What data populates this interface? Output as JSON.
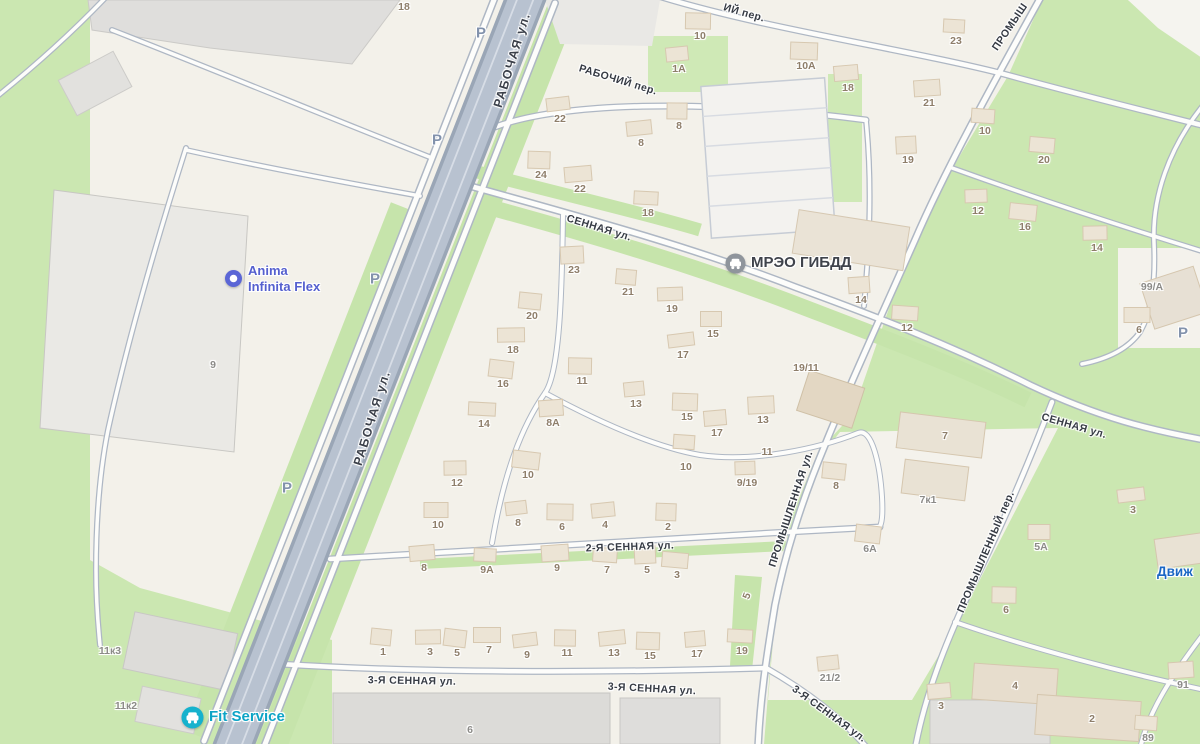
{
  "map": {
    "colors": {
      "green_area": "#cbe7b1",
      "road_major_fill": "#b8c2d0",
      "road_casing": "#aeb7c4",
      "street_text": "#363b44",
      "address_text": "#8e7e6a",
      "poi_anima": "#5560cf",
      "poi_mreo": "#3f434b",
      "poi_fit_service": "#0da4c6",
      "poi_dvizh": "#1a66c4",
      "parking_text": "#8292ac"
    },
    "parking_glyph": "P",
    "street_labels": [
      {
        "t": "РАБОЧАЯ ул.",
        "x": 512,
        "y": 60,
        "rot": -73,
        "major": true
      },
      {
        "t": "РАБОЧАЯ ул.",
        "x": 372,
        "y": 418,
        "rot": -73,
        "major": true
      },
      {
        "t": "РАБОЧИЙ пер.",
        "x": 618,
        "y": 80,
        "rot": 17
      },
      {
        "t": "ИЙ пер.",
        "x": 744,
        "y": 13,
        "rot": 16
      },
      {
        "t": "СЕННАЯ ул.",
        "x": 599,
        "y": 228,
        "rot": 17
      },
      {
        "t": "СЕННАЯ ул.",
        "x": 1074,
        "y": 426,
        "rot": 16
      },
      {
        "t": "2-Я СЕННАЯ ул.",
        "x": 630,
        "y": 547,
        "rot": -2
      },
      {
        "t": "3-Я СЕННАЯ ул.",
        "x": 412,
        "y": 681,
        "rot": 1
      },
      {
        "t": "3-Я СЕННАЯ ул.",
        "x": 652,
        "y": 689,
        "rot": 3
      },
      {
        "t": "3-Я СЕННАЯ ул.",
        "x": 829,
        "y": 714,
        "rot": 36
      },
      {
        "t": "ПРОМЫШЛЕННАЯ ул.",
        "x": 791,
        "y": 509,
        "rot": -72
      },
      {
        "t": "ПРОМЫШЛЕННЫЙ пер.",
        "x": 986,
        "y": 552,
        "rot": -67
      },
      {
        "t": "ПРОМЫШ",
        "x": 1010,
        "y": 27,
        "rot": -56
      }
    ],
    "pois": [
      {
        "id": "anima-infinita-flex",
        "icon": "ring",
        "x": 224,
        "y": 263,
        "color": "#5560cf",
        "size": 13,
        "lines": [
          "Anima",
          "Infinita Flex"
        ]
      },
      {
        "id": "mreo-gibdd",
        "icon": "car-gray",
        "x": 725,
        "y": 253,
        "color": "#3f434b",
        "size": 15,
        "lines": [
          "МРЭО ГИБДД"
        ]
      },
      {
        "id": "fit-service",
        "icon": "car-teal",
        "x": 181,
        "y": 706,
        "color": "#0da4c6",
        "size": 15,
        "lines": [
          "Fit Service"
        ]
      },
      {
        "id": "dvizh",
        "icon": "none",
        "x": 1157,
        "y": 564,
        "color": "#1a66c4",
        "size": 13.5,
        "lines": [
          "Движ"
        ]
      }
    ],
    "parking_markers": [
      {
        "x": 481,
        "y": 33
      },
      {
        "x": 437,
        "y": 140
      },
      {
        "x": 375,
        "y": 279
      },
      {
        "x": 287,
        "y": 488
      },
      {
        "x": 1183,
        "y": 333
      }
    ],
    "addresses": [
      {
        "t": "18",
        "x": 404,
        "y": 7,
        "nh": 1
      },
      {
        "t": "10",
        "x": 700,
        "y": 36
      },
      {
        "t": "1А",
        "x": 679,
        "y": 69
      },
      {
        "t": "10А",
        "x": 806,
        "y": 66
      },
      {
        "t": "18",
        "x": 848,
        "y": 88
      },
      {
        "t": "23",
        "x": 956,
        "y": 41
      },
      {
        "t": "21",
        "x": 929,
        "y": 103
      },
      {
        "t": "10",
        "x": 985,
        "y": 131
      },
      {
        "t": "19",
        "x": 908,
        "y": 160
      },
      {
        "t": "20",
        "x": 1044,
        "y": 160
      },
      {
        "t": "12",
        "x": 978,
        "y": 211
      },
      {
        "t": "16",
        "x": 1025,
        "y": 227
      },
      {
        "t": "14",
        "x": 1097,
        "y": 248
      },
      {
        "t": "99/А",
        "x": 1152,
        "y": 287,
        "g": 1,
        "nh": 1
      },
      {
        "t": "6",
        "x": 1139,
        "y": 330
      },
      {
        "t": "22",
        "x": 560,
        "y": 119
      },
      {
        "t": "8",
        "x": 679,
        "y": 126
      },
      {
        "t": "8",
        "x": 641,
        "y": 143
      },
      {
        "t": "24",
        "x": 541,
        "y": 175
      },
      {
        "t": "22",
        "x": 580,
        "y": 189
      },
      {
        "t": "18",
        "x": 648,
        "y": 213
      },
      {
        "t": "14",
        "x": 861,
        "y": 300
      },
      {
        "t": "12",
        "x": 907,
        "y": 328
      },
      {
        "t": "23",
        "x": 574,
        "y": 270
      },
      {
        "t": "21",
        "x": 628,
        "y": 292
      },
      {
        "t": "19",
        "x": 672,
        "y": 309
      },
      {
        "t": "20",
        "x": 532,
        "y": 316
      },
      {
        "t": "18",
        "x": 513,
        "y": 350
      },
      {
        "t": "16",
        "x": 503,
        "y": 384
      },
      {
        "t": "15",
        "x": 713,
        "y": 334
      },
      {
        "t": "17",
        "x": 683,
        "y": 355
      },
      {
        "t": "11",
        "x": 582,
        "y": 381
      },
      {
        "t": "13",
        "x": 636,
        "y": 404
      },
      {
        "t": "15",
        "x": 687,
        "y": 417
      },
      {
        "t": "17",
        "x": 717,
        "y": 433
      },
      {
        "t": "14",
        "x": 484,
        "y": 424
      },
      {
        "t": "8А",
        "x": 553,
        "y": 423
      },
      {
        "t": "10",
        "x": 686,
        "y": 467,
        "dy": -10
      },
      {
        "t": "13",
        "x": 763,
        "y": 420
      },
      {
        "t": "11",
        "x": 767,
        "y": 452,
        "nh": 1
      },
      {
        "t": "9/19",
        "x": 747,
        "y": 483
      },
      {
        "t": "19/11",
        "x": 806,
        "y": 368,
        "nh": 1
      },
      {
        "t": "12",
        "x": 457,
        "y": 483
      },
      {
        "t": "10",
        "x": 528,
        "y": 475
      },
      {
        "t": "10",
        "x": 438,
        "y": 525
      },
      {
        "t": "8",
        "x": 518,
        "y": 523
      },
      {
        "t": "6",
        "x": 562,
        "y": 527
      },
      {
        "t": "4",
        "x": 605,
        "y": 525
      },
      {
        "t": "2",
        "x": 668,
        "y": 527
      },
      {
        "t": "8",
        "x": 424,
        "y": 568
      },
      {
        "t": "9А",
        "x": 487,
        "y": 570
      },
      {
        "t": "9",
        "x": 557,
        "y": 568
      },
      {
        "t": "7",
        "x": 607,
        "y": 570
      },
      {
        "t": "5",
        "x": 647,
        "y": 570
      },
      {
        "t": "3",
        "x": 677,
        "y": 575
      },
      {
        "t": "5",
        "x": 747,
        "y": 596,
        "rot": -70,
        "nh": 1
      },
      {
        "t": "1",
        "x": 383,
        "y": 652
      },
      {
        "t": "3",
        "x": 430,
        "y": 652
      },
      {
        "t": "5",
        "x": 457,
        "y": 653
      },
      {
        "t": "7",
        "x": 489,
        "y": 650
      },
      {
        "t": "9",
        "x": 527,
        "y": 655
      },
      {
        "t": "11",
        "x": 567,
        "y": 653
      },
      {
        "t": "13",
        "x": 614,
        "y": 653
      },
      {
        "t": "15",
        "x": 650,
        "y": 656
      },
      {
        "t": "17",
        "x": 697,
        "y": 654
      },
      {
        "t": "19",
        "x": 742,
        "y": 651
      },
      {
        "t": "9",
        "x": 213,
        "y": 365,
        "g": 1,
        "nh": 1
      },
      {
        "t": "11к3",
        "x": 110,
        "y": 651,
        "g": 1,
        "nh": 1
      },
      {
        "t": "11к2",
        "x": 126,
        "y": 706,
        "g": 1,
        "nh": 1
      },
      {
        "t": "6",
        "x": 470,
        "y": 730,
        "g": 1,
        "nh": 1
      },
      {
        "t": "7",
        "x": 945,
        "y": 436,
        "nh": 1
      },
      {
        "t": "8",
        "x": 836,
        "y": 486
      },
      {
        "t": "7к1",
        "x": 928,
        "y": 500,
        "g": 1,
        "nh": 1
      },
      {
        "t": "6А",
        "x": 870,
        "y": 549,
        "g": 1
      },
      {
        "t": "5А",
        "x": 1041,
        "y": 547,
        "g": 1
      },
      {
        "t": "3",
        "x": 1133,
        "y": 510
      },
      {
        "t": "6",
        "x": 1006,
        "y": 610
      },
      {
        "t": "21/2",
        "x": 830,
        "y": 678,
        "g": 1
      },
      {
        "t": "4",
        "x": 1015,
        "y": 686,
        "nh": 1
      },
      {
        "t": "3",
        "x": 941,
        "y": 706
      },
      {
        "t": "2",
        "x": 1092,
        "y": 719,
        "nh": 1
      },
      {
        "t": "91",
        "x": 1183,
        "y": 685,
        "g": 1
      },
      {
        "t": "89",
        "x": 1148,
        "y": 738,
        "g": 1
      }
    ]
  }
}
